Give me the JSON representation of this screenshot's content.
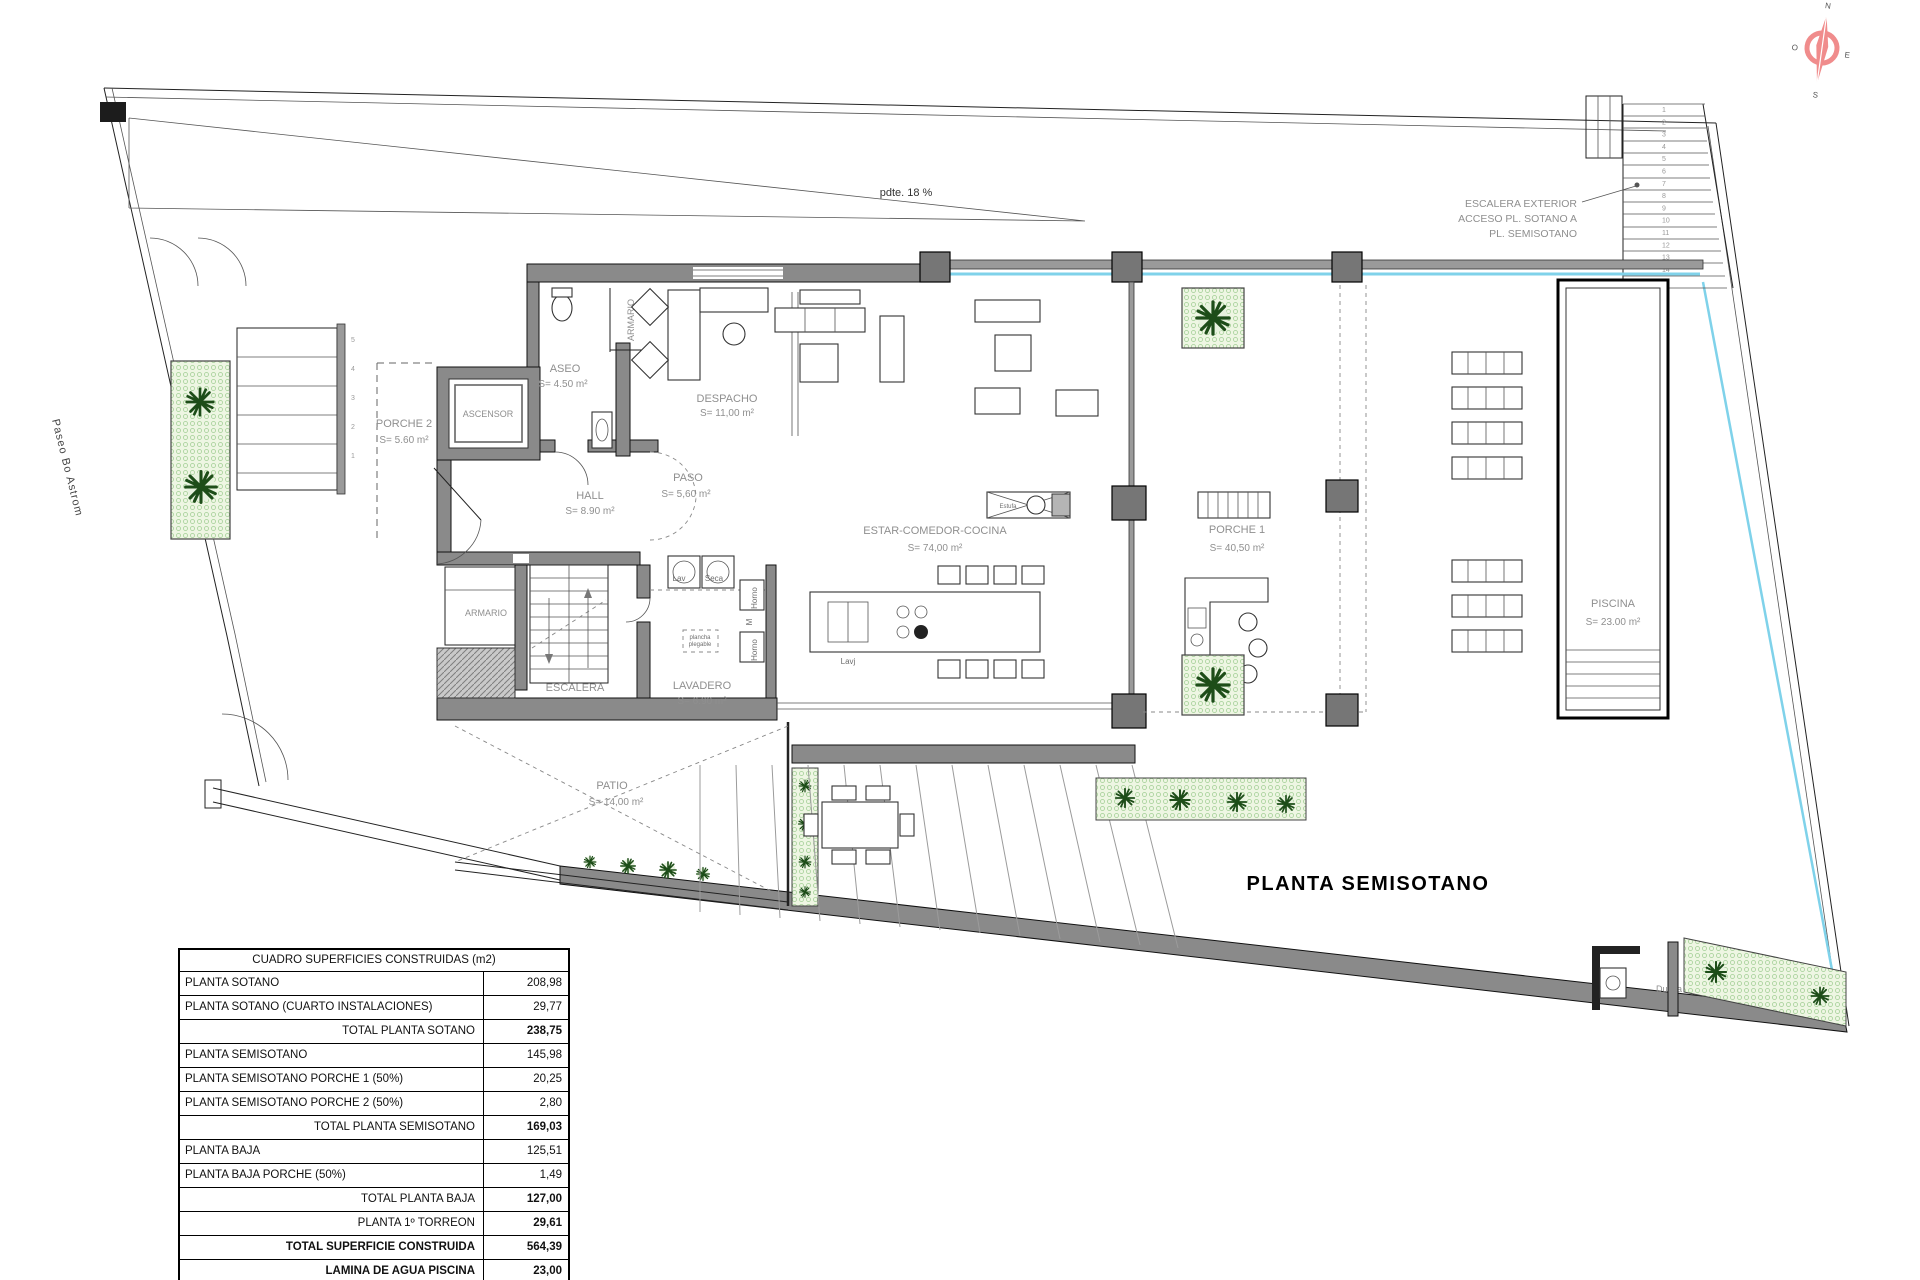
{
  "title": "PLANTA SEMISOTANO",
  "annotations": {
    "slope": "pdte. 18 %",
    "street": "Paseo Bo Astrom",
    "stair_note_1": "ESCALERA EXTERIOR",
    "stair_note_2": "ACCESO PL. SOTANO A",
    "stair_note_3": "PL. SEMISOTANO"
  },
  "compass": {
    "north": "N",
    "south": "S",
    "east": "E",
    "west": "O"
  },
  "rooms": [
    {
      "name": "PORCHE 2",
      "area": "S= 5.60 m²"
    },
    {
      "name": "ASCENSOR",
      "area": ""
    },
    {
      "name": "ASEO",
      "area": "S= 4.50 m²"
    },
    {
      "name": "ARMARIO",
      "area": ""
    },
    {
      "name": "DESPACHO",
      "area": "S= 11,00 m²"
    },
    {
      "name": "HALL",
      "area": "S= 8.90 m²"
    },
    {
      "name": "PASO",
      "area": "S= 5,60 m²"
    },
    {
      "name": "ARMARIO",
      "area": ""
    },
    {
      "name": "ESCALERA",
      "area": ""
    },
    {
      "name": "LAVADERO",
      "area": "S= 6.90 m²"
    },
    {
      "name": "ESTAR-COMEDOR-COCINA",
      "area": "S= 74,00 m²"
    },
    {
      "name": "PORCHE 1",
      "area": "S= 40,50 m²"
    },
    {
      "name": "PATIO",
      "area": "S= 14,00 m²"
    },
    {
      "name": "PISCINA",
      "area": "S= 23.00 m²"
    }
  ],
  "fixtures": {
    "washer": "Lav",
    "dryer": "Seca",
    "oven_upper": "Horno",
    "micro": "M",
    "oven_lower": "Horno",
    "sink": "Lavj",
    "ironing_1": "plancha",
    "ironing_2": "plegable",
    "stove": "Estufa",
    "bar": "BAR",
    "shower": "Ducha"
  },
  "stairs": {
    "left_numbers": [
      "5",
      "4",
      "3",
      "2",
      "1"
    ],
    "exterior_numbers": [
      "1",
      "2",
      "3",
      "4",
      "5",
      "6",
      "7",
      "8",
      "9",
      "10",
      "11",
      "12",
      "13",
      "14",
      "15"
    ]
  },
  "table": {
    "header": "CUADRO SUPERFICIES CONSTRUIDAS (m2)",
    "rows": [
      {
        "label": "PLANTA SOTANO",
        "value": "208,98"
      },
      {
        "label": "PLANTA SOTANO (CUARTO INSTALACIONES)",
        "value": "29,77"
      },
      {
        "label": "TOTAL PLANTA SOTANO",
        "value": "238,75"
      },
      {
        "label": "PLANTA SEMISOTANO",
        "value": "145,98"
      },
      {
        "label": "PLANTA SEMISOTANO PORCHE 1 (50%)",
        "value": "20,25"
      },
      {
        "label": "PLANTA SEMISOTANO PORCHE 2 (50%)",
        "value": "2,80"
      },
      {
        "label": "TOTAL PLANTA SEMISOTANO",
        "value": "169,03"
      },
      {
        "label": "PLANTA BAJA",
        "value": "125,51"
      },
      {
        "label": "PLANTA BAJA PORCHE (50%)",
        "value": "1,49"
      },
      {
        "label": "TOTAL PLANTA BAJA",
        "value": "127,00"
      },
      {
        "label": "PLANTA 1º TORREON",
        "value": "29,61"
      },
      {
        "label": "TOTAL SUPERFICIE CONSTRUIDA",
        "value": "564,39"
      },
      {
        "label": "LAMINA DE AGUA PISCINA",
        "value": "23,00"
      }
    ]
  },
  "colors": {
    "water": "#7fd2ea",
    "vegetation": "#a3cf96",
    "wall": "#8a8a8a",
    "compass": "#f08c8c"
  }
}
